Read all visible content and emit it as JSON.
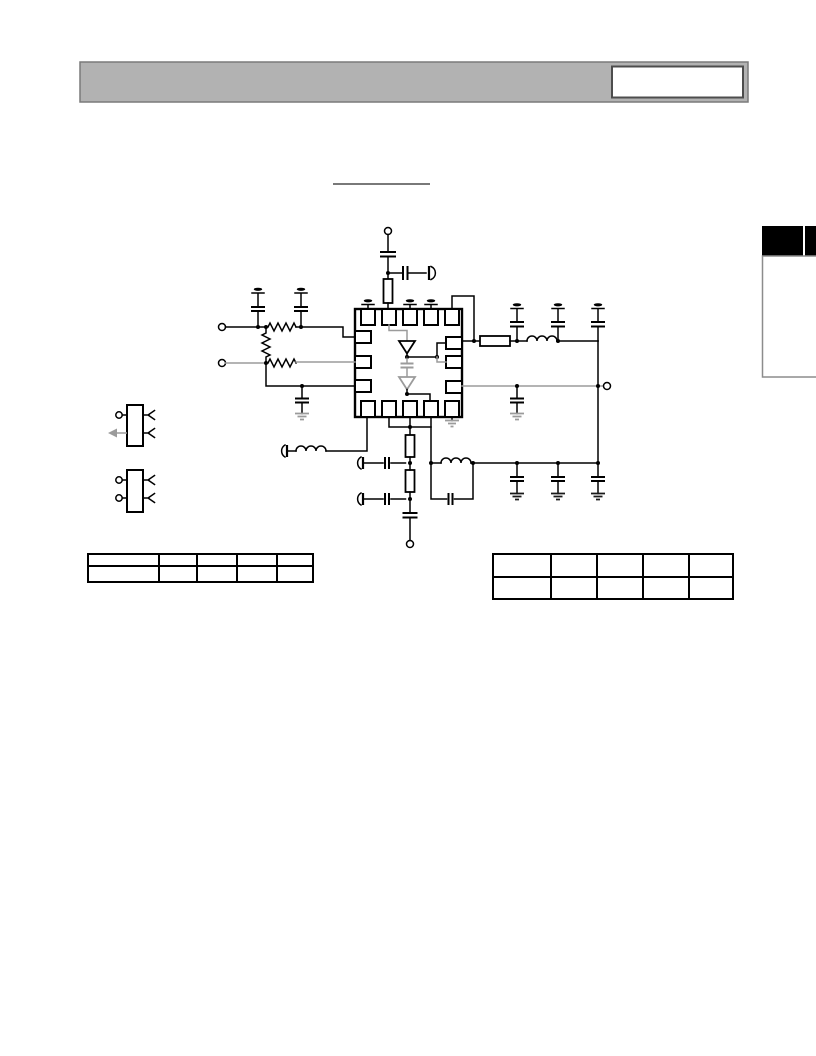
{
  "colors": {
    "page_bg": "#ffffff",
    "header_bar": "#b2b2b2",
    "header_bar_border": "#7a7a7a",
    "header_box_fill": "#ffffff",
    "header_box_border": "#4d4d4d",
    "section_tab": "#000000",
    "tab_divider": "#ffffff",
    "sidebar_box_fill": "#ffffff",
    "sidebar_box_border": "#8c8c8c",
    "wire_primary": "#000000",
    "wire_secondary": "#9b9b9b",
    "title_underline": "#4d4d4d",
    "table_border": "#000000"
  },
  "schematic": {
    "ic": {
      "package_style": "quad-flat-no-lead",
      "pads": {
        "top": 5,
        "bottom": 5,
        "left": 3,
        "right": 3
      },
      "internal": [
        "buffer-amplifier",
        "coupling-capacitor",
        "buffer-amplifier"
      ]
    },
    "component_inventory": [
      "input-terminal",
      "input-terminal",
      "output-terminal",
      "supply-terminal",
      "bottom-terminal",
      "series-resistor",
      "series-resistor",
      "shunt-resistor",
      "feed-resistor",
      "decoupling-capacitor-bank",
      "rf-inductor",
      "rf-inductor",
      "lc-tank",
      "header-connector-2pin",
      "header-connector-2pin",
      "ground-symbol",
      "supply-flag",
      "rf-probe-point"
    ]
  },
  "tables": {
    "left": {
      "columns": 5,
      "rows": 2,
      "cells": [
        [
          "",
          "",
          "",
          "",
          ""
        ],
        [
          "",
          "",
          "",
          "",
          ""
        ]
      ]
    },
    "right": {
      "columns": 5,
      "rows": 2,
      "cells": [
        [
          "",
          "",
          "",
          "",
          ""
        ],
        [
          "",
          "",
          "",
          "",
          ""
        ]
      ]
    }
  }
}
